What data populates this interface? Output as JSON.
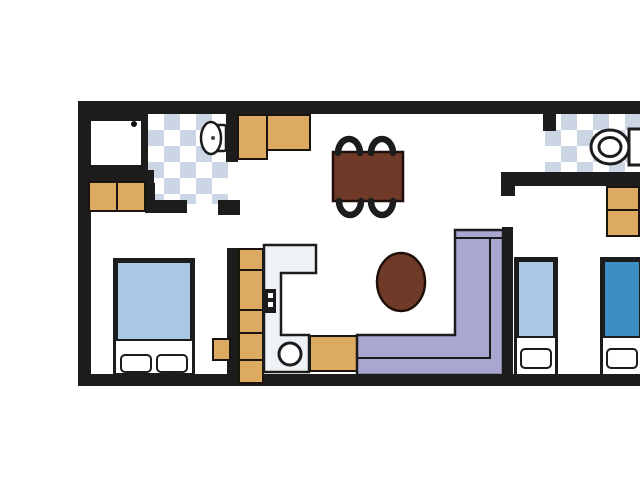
{
  "canvas": {
    "width": 640,
    "height": 480,
    "background": "#ffffff"
  },
  "colors": {
    "wall": "#1c1c1c",
    "tan": "#dcaa62",
    "tan-border": "#1a140d",
    "wood": "#6f3a27",
    "wood-border": "#200f08",
    "sofa": "#a9a7d0",
    "tile": "#ccd5e4",
    "bed-light": "#a9c8e3",
    "bed-blue": "#3e8ec6",
    "counter": "#eef1f6",
    "fixture": "#ffffff"
  },
  "plan": {
    "type": "apartment-floor-plan",
    "rooms": [
      {
        "name": "bathroom-left",
        "features": [
          "shower",
          "toilet",
          "checkered-tile-floor",
          "cabinets"
        ]
      },
      {
        "name": "bedroom-left",
        "features": [
          "double-bed",
          "side-cabinet"
        ]
      },
      {
        "name": "kitchen",
        "features": [
          "cabinet-run",
          "l-shaped-counter",
          "stove",
          "round-sink",
          "appliance-cabinet"
        ]
      },
      {
        "name": "dining-living",
        "features": [
          "dining-table",
          "four-chairs",
          "l-shaped-sofa",
          "oval-coffee-table"
        ]
      },
      {
        "name": "bathroom-right",
        "features": [
          "toilet",
          "wash-basin",
          "checkered-tile-floor"
        ]
      },
      {
        "name": "bedroom-right",
        "features": [
          "single-bed-light",
          "single-bed-dark",
          "wardrobe"
        ]
      }
    ]
  }
}
